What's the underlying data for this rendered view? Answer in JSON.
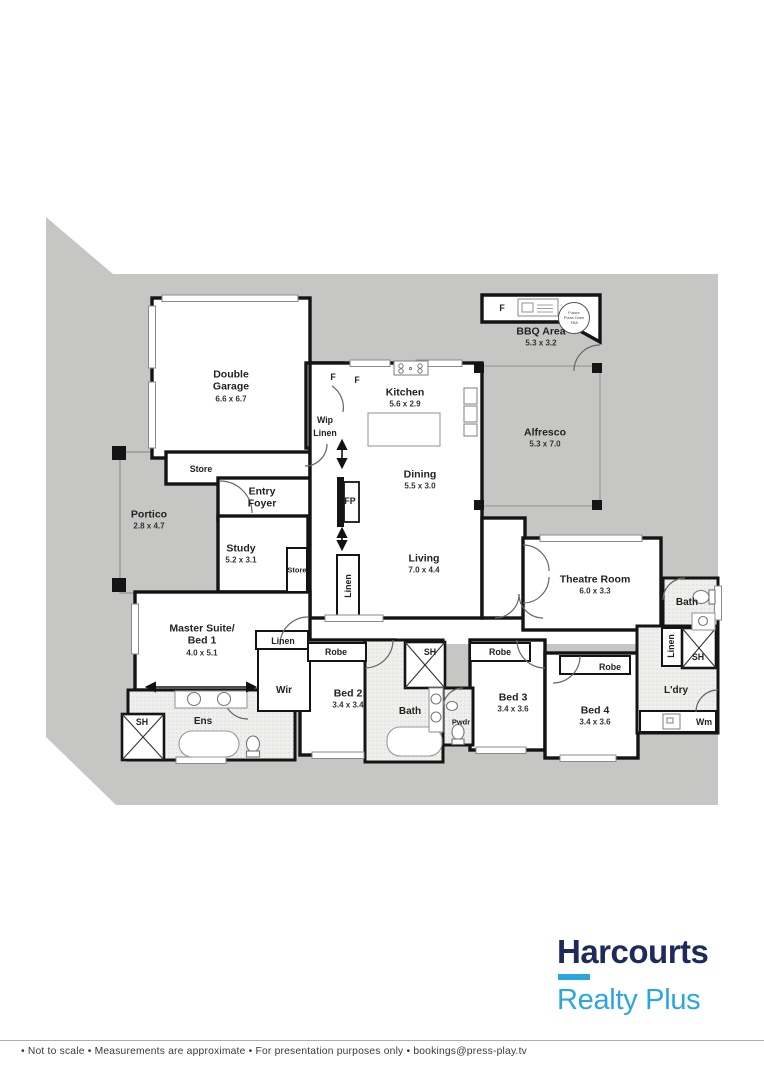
{
  "plan": {
    "labels": [
      {
        "name": "Double\nGarage",
        "dims": "6.6 x 6.7",
        "x": 231,
        "y": 386,
        "s": "lg"
      },
      {
        "name": "Store",
        "x": 201,
        "y": 469,
        "s": "sm"
      },
      {
        "name": "Portico",
        "dims": "2.8 x 4.7",
        "x": 149,
        "y": 520,
        "s": "lg"
      },
      {
        "name": "Entry\nFoyer",
        "x": 262,
        "y": 498,
        "s": "lg"
      },
      {
        "name": "Study",
        "dims": "5.2 x 3.1",
        "x": 241,
        "y": 554,
        "s": "lg"
      },
      {
        "name": "Store",
        "x": 297,
        "y": 571,
        "s": "xs"
      },
      {
        "name": "F",
        "x": 333,
        "y": 377,
        "s": "sm"
      },
      {
        "name": "F",
        "x": 357,
        "y": 380,
        "s": "sm"
      },
      {
        "name": "Wip",
        "x": 325,
        "y": 420,
        "s": "sm"
      },
      {
        "name": "Linen",
        "x": 325,
        "y": 433,
        "s": "sm"
      },
      {
        "name": "Kitchen",
        "dims": "5.6 x 2.9",
        "x": 405,
        "y": 398,
        "s": "lg"
      },
      {
        "name": "Dining",
        "dims": "5.5 x 3.0",
        "x": 420,
        "y": 480,
        "s": "lg"
      },
      {
        "name": "FP",
        "x": 350,
        "y": 501,
        "s": "sm"
      },
      {
        "name": "Linen",
        "x": 348,
        "y": 586,
        "s": "sm",
        "rot": true
      },
      {
        "name": "Living",
        "dims": "7.0 x 4.4",
        "x": 424,
        "y": 564,
        "s": "lg"
      },
      {
        "name": "F",
        "x": 502,
        "y": 308,
        "s": "sm"
      },
      {
        "name": "BBQ Area",
        "dims": "5.3 x 3.2",
        "x": 541,
        "y": 337,
        "s": "lg"
      },
      {
        "name": "Future\nPizza Oven\nTBA",
        "x": 574,
        "y": 318,
        "s": "micro"
      },
      {
        "name": "Alfresco",
        "dims": "5.3 x 7.0",
        "x": 545,
        "y": 438,
        "s": "lg"
      },
      {
        "name": "Theatre Room",
        "dims": "6.0 x 3.3",
        "x": 595,
        "y": 585,
        "s": "lg"
      },
      {
        "name": "Bath",
        "x": 687,
        "y": 603,
        "s": "md"
      },
      {
        "name": "Linen",
        "x": 671,
        "y": 646,
        "s": "sm",
        "rot": true
      },
      {
        "name": "SH",
        "x": 698,
        "y": 657,
        "s": "sm"
      },
      {
        "name": "L'dry",
        "x": 676,
        "y": 691,
        "s": "md"
      },
      {
        "name": "Wm",
        "x": 704,
        "y": 722,
        "s": "sm"
      },
      {
        "name": "Master Suite/\nBed 1",
        "dims": "4.0 x 5.1",
        "x": 202,
        "y": 640,
        "s": "lg"
      },
      {
        "name": "Linen",
        "x": 283,
        "y": 641,
        "s": "sm"
      },
      {
        "name": "Wir",
        "x": 284,
        "y": 691,
        "s": "md"
      },
      {
        "name": "Robe",
        "x": 336,
        "y": 652,
        "s": "sm"
      },
      {
        "name": "Bed 2",
        "dims": "3.4 x 3.4",
        "x": 348,
        "y": 699,
        "s": "lg"
      },
      {
        "name": "SH",
        "x": 430,
        "y": 652,
        "s": "sm"
      },
      {
        "name": "Bath",
        "x": 410,
        "y": 712,
        "s": "md"
      },
      {
        "name": "Pwdr",
        "x": 461,
        "y": 723,
        "s": "xs"
      },
      {
        "name": "Robe",
        "x": 500,
        "y": 652,
        "s": "sm"
      },
      {
        "name": "Bed 3",
        "dims": "3.4 x 3.6",
        "x": 513,
        "y": 703,
        "s": "lg"
      },
      {
        "name": "Robe",
        "x": 610,
        "y": 667,
        "s": "sm"
      },
      {
        "name": "Bed 4",
        "dims": "3.4 x 3.6",
        "x": 595,
        "y": 716,
        "s": "lg"
      },
      {
        "name": "SH",
        "x": 142,
        "y": 722,
        "s": "sm"
      },
      {
        "name": "Ens",
        "x": 203,
        "y": 722,
        "s": "md"
      }
    ],
    "colors": {
      "land": "#c6c6c5",
      "wall": "#141414",
      "wet_floor": "#efefed"
    }
  },
  "logo": {
    "brand": "Harcourts",
    "sub": "Realty Plus",
    "brand_color": "#1d2b5c",
    "accent_color": "#2ca6e0"
  },
  "footer": {
    "text": "• Not to scale • Measurements are approximate • For presentation purposes only • bookings@press-play.tv"
  }
}
